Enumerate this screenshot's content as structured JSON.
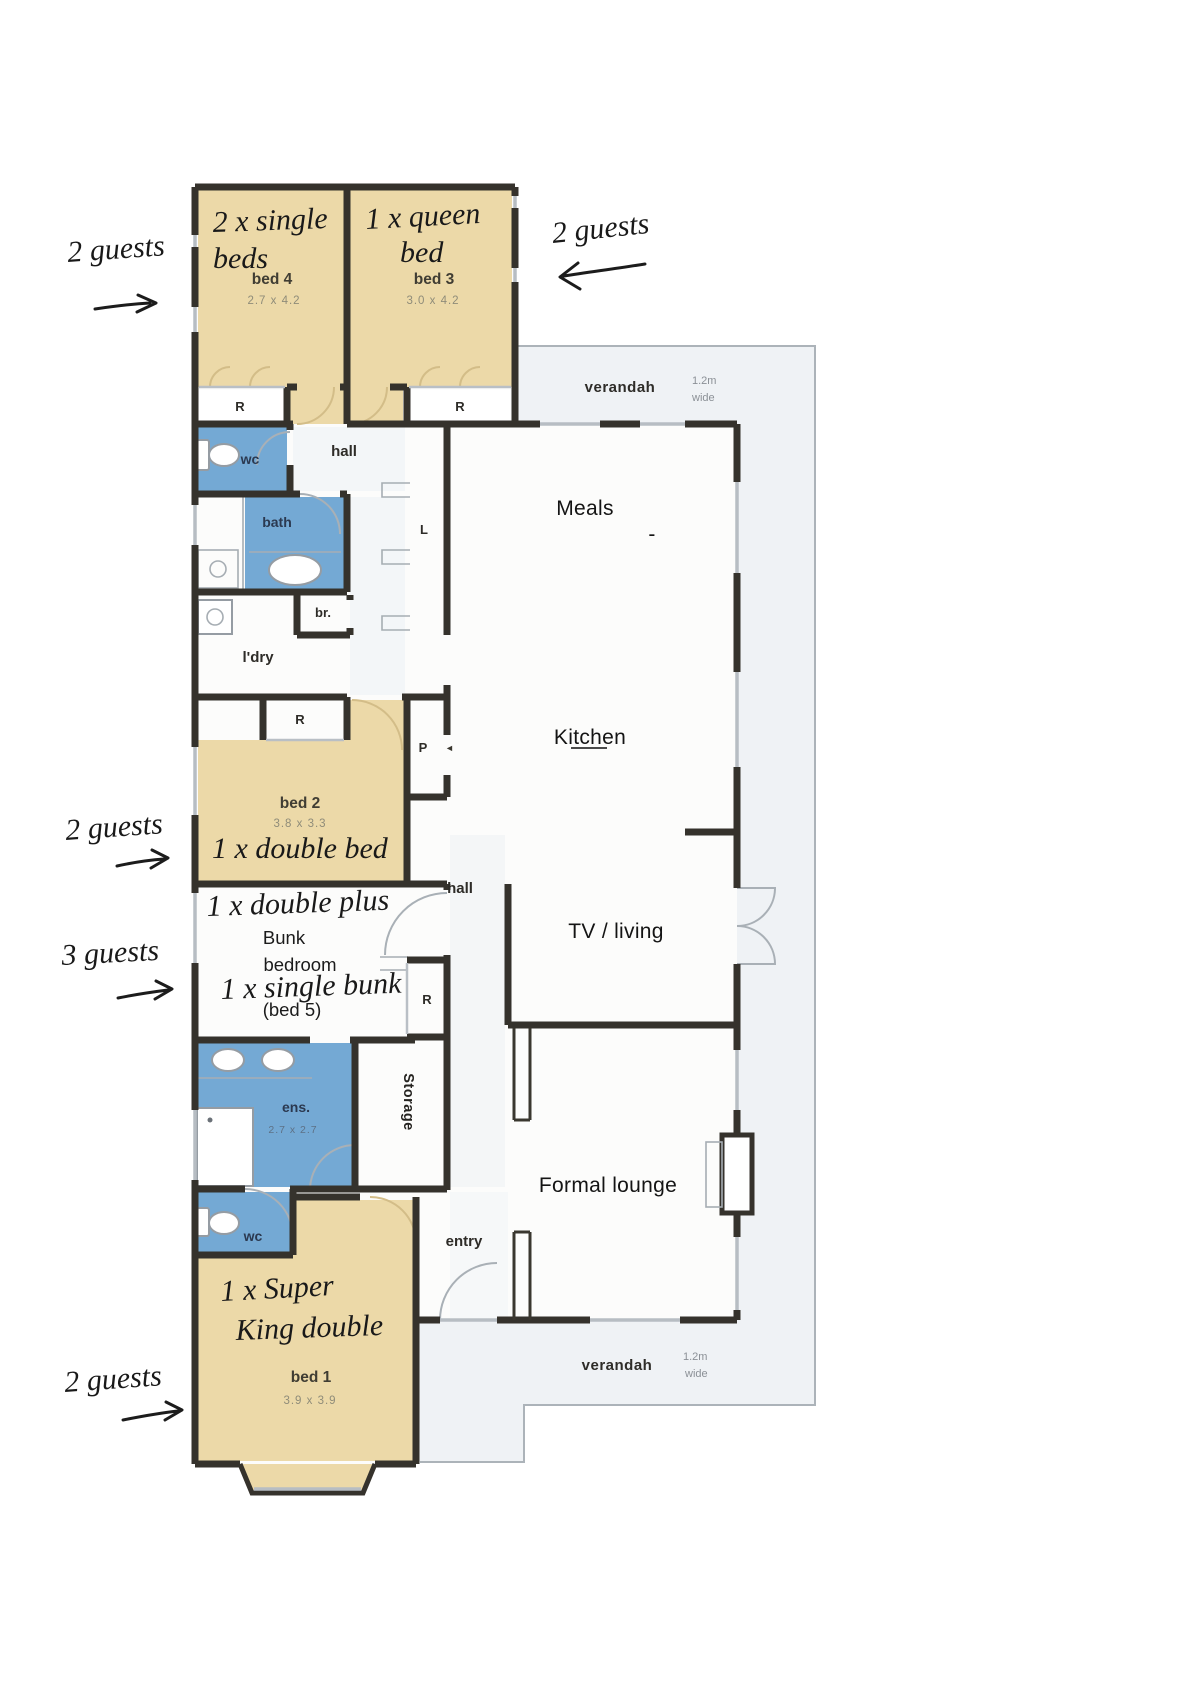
{
  "plan": {
    "bed4": {
      "label": "bed 4",
      "dims": "2.7 x 4.2",
      "hw1": "2 x single",
      "hw2": "beds"
    },
    "bed3": {
      "label": "bed 3",
      "dims": "3.0 x 4.2",
      "hw1": "1 x queen",
      "hw2": "bed"
    },
    "bed2": {
      "label": "bed 2",
      "dims": "3.8 x 3.3",
      "hw": "1 x double bed"
    },
    "bed1": {
      "label": "bed 1",
      "dims": "3.9 x 3.9",
      "hw1": "1 x Super",
      "hw2": "King double"
    },
    "bunk": {
      "hw1": "1 x double plus",
      "line1": "Bunk",
      "line2": "bedroom",
      "hw2": "1 x single bunk",
      "line3": "(bed 5)"
    },
    "ens": {
      "label": "ens.",
      "dims": "2.7 x 2.7"
    },
    "robe": "R",
    "linen": "L",
    "pantry": "P",
    "pantry_arrow": "◄",
    "wc": "wc",
    "bath": "bath",
    "br": "br.",
    "laundry": "l'dry",
    "hall": "hall",
    "storage": "Storage",
    "entry": "entry",
    "meals": "Meals",
    "dash": "-",
    "kitchen": "Kitchen",
    "tv_living": "TV / living",
    "formal_lounge": "Formal lounge",
    "verandah": "verandah",
    "verandah_w1": "1.2m",
    "verandah_w2": "wide"
  },
  "annotations": {
    "guests2": "2 guests",
    "guests3": "3 guests"
  },
  "colors": {
    "bedroom_fill": "#ecd9a8",
    "wet_fill": "#74a9d4",
    "wall": "#35322c",
    "verandah_fill": "#eff2f5",
    "verandah_line": "#acb3b9"
  }
}
